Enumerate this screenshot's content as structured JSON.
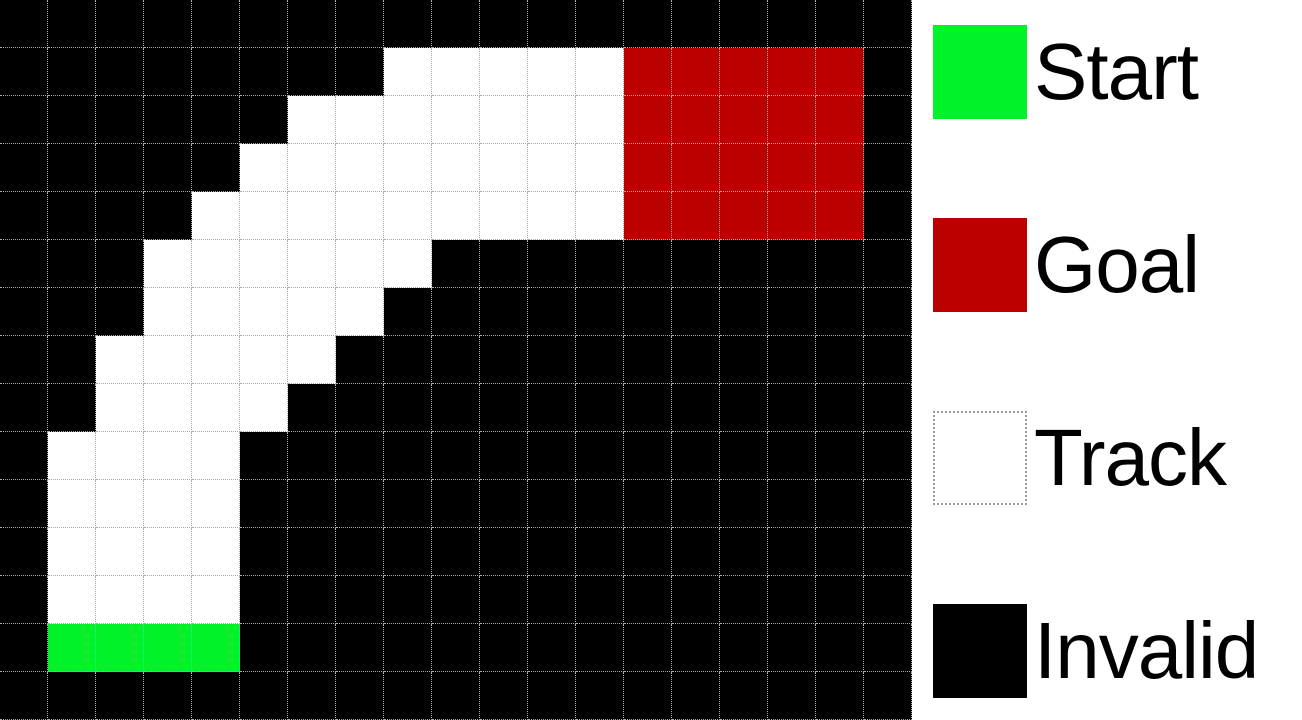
{
  "figure": {
    "kind": "racetrack-gridworld-diagram"
  },
  "grid": {
    "cols": 19,
    "rows": 15,
    "cell_size_px": 48,
    "gridline_color": "#AAAAAA",
    "cell_types": {
      "B": {
        "name": "invalid",
        "color": "#000000"
      },
      "T": {
        "name": "track",
        "color": "#FFFFFF"
      },
      "S": {
        "name": "start",
        "color": "#00F228"
      },
      "G": {
        "name": "goal",
        "color": "#BB0000"
      }
    },
    "map": [
      "BBBBBBBBBBBBBBBBBBB",
      "BBBBBBBBTTTTTGGGGGB",
      "BBBBBBTTTTTTTGGGGGB",
      "BBBBBTTTTTTTTGGGGGB",
      "BBBBTTTTTTTTTGGGGGB",
      "BBBTTTTTTBBBBBBBBBB",
      "BBBTTTTTBBBBBBBBBBB",
      "BBTTTTTBBBBBBBBBBBB",
      "BBTTTTBBBBBBBBBBBBB",
      "BTTTTBBBBBBBBBBBBBB",
      "BTTTTBBBBBBBBBBBBBB",
      "BTTTTBBBBBBBBBBBBBB",
      "BTTTTBBBBBBBBBBBBBB",
      "BSSSSBBBBBBBBBBBBBB",
      "BBBBBBBBBBBBBBBBBBB"
    ]
  },
  "legend": {
    "items": [
      {
        "label": "Start",
        "type": "start",
        "color": "#00F228",
        "border": "none"
      },
      {
        "label": "Goal",
        "type": "goal",
        "color": "#BB0000",
        "border": "none"
      },
      {
        "label": "Track",
        "type": "track",
        "color": "#FFFFFF",
        "border": "dotted",
        "border_color": "#999999"
      },
      {
        "label": "Invalid",
        "type": "invalid",
        "color": "#000000",
        "border": "none"
      }
    ]
  }
}
